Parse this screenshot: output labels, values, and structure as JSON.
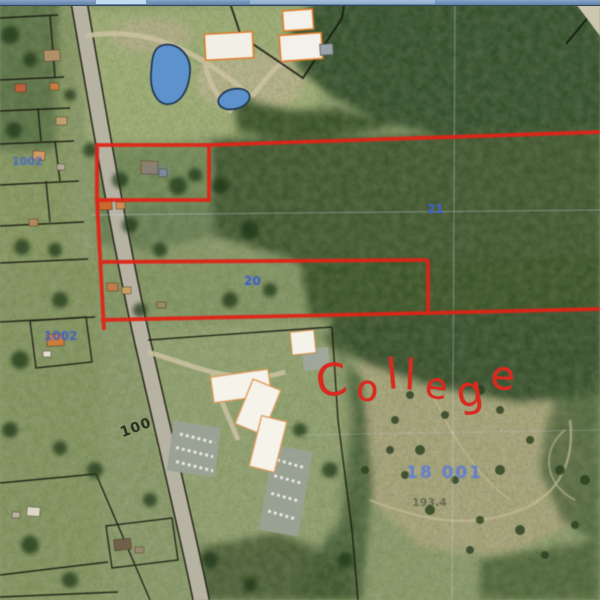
{
  "map": {
    "annotation": {
      "college_text": "College",
      "color": "#d92a1f"
    },
    "labels": {
      "section_21": "21",
      "parcel_20": "20",
      "road_100": "100",
      "parcel_left_top": "1002",
      "parcel_house": "1002",
      "parcel_in_red_rect": "1001",
      "parcel_big_tract": "18 001",
      "acreage": "193.4"
    },
    "colors": {
      "boundary_red": "#e02418",
      "label_blue": "#3f5fc2",
      "pond_blue": "#5e92cc",
      "chrome_bar": "#6e8fb4",
      "chrome_tab": "#c3dbee"
    }
  }
}
